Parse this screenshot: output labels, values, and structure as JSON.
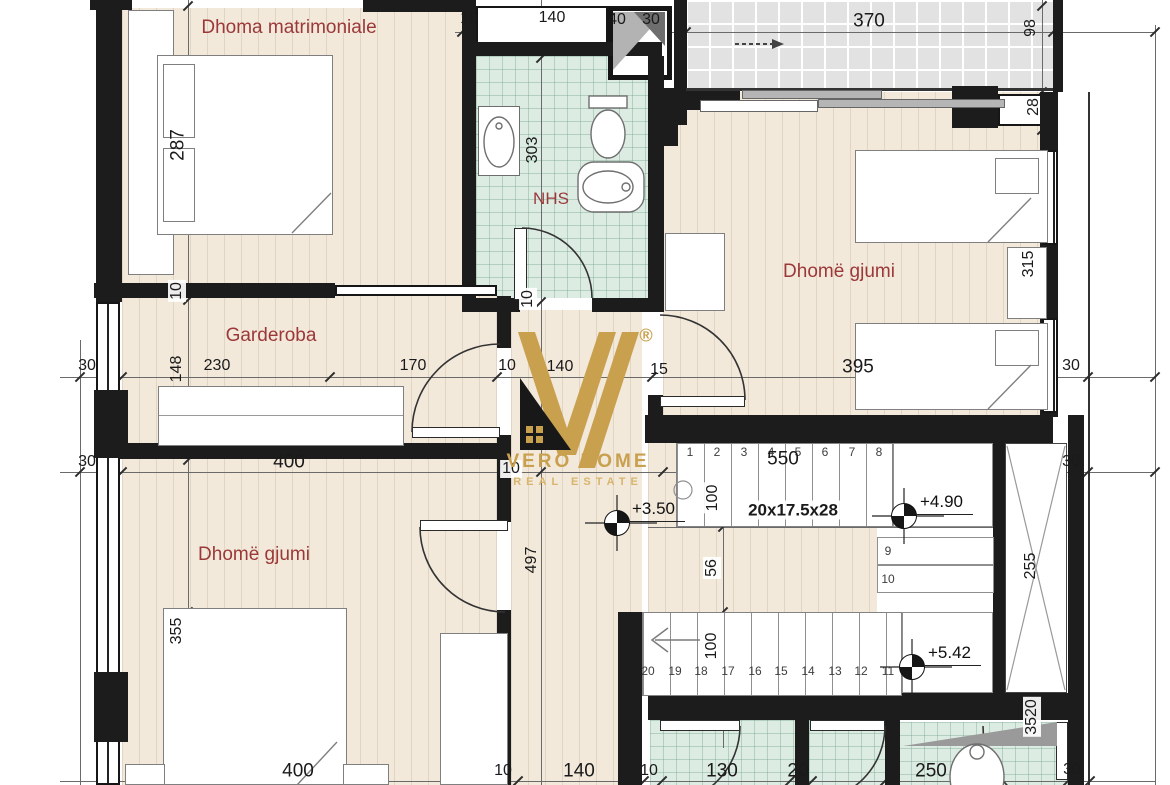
{
  "page": {
    "type": "architectural floor plan"
  },
  "rooms": {
    "master": "Dhoma matrimoniale",
    "bath": "NHS",
    "wardrobe": "Garderoba",
    "bedroom_right": "Dhomë gjumi",
    "bedroom_left": "Dhomë gjumi"
  },
  "logo": {
    "brand": "VERO HOME",
    "tagline": "REAL ESTATE",
    "mark": "®"
  },
  "elevations": {
    "hall": "+3.50",
    "landing": "+4.90",
    "top": "+5.42"
  },
  "stairs": {
    "spec": "20x17.5x28",
    "top_steps": [
      "1",
      "2",
      "3",
      "4",
      "5",
      "6",
      "7",
      "8"
    ],
    "side_steps": [
      "9",
      "10"
    ],
    "bottom_steps": [
      "20",
      "19",
      "18",
      "17",
      "16",
      "15",
      "14",
      "13",
      "12",
      "11"
    ]
  },
  "dims": {
    "top_line": [
      "10",
      "140",
      "40",
      "30",
      "370"
    ],
    "right_col": [
      "98",
      "28"
    ],
    "master_depth": "287",
    "wall_a": "10",
    "mid_line": [
      "30",
      "148",
      "230",
      "170",
      "10",
      "140",
      "15",
      "395",
      "30"
    ],
    "second_line": [
      "30",
      "400",
      "10",
      "550",
      "30"
    ],
    "bath_depth": "303",
    "wall_b": "10",
    "bedroom_right_depth": "315",
    "hall_depth": "497",
    "bedroom_left_depth": "355",
    "stair_segments": [
      "100",
      "56",
      "100"
    ],
    "elevator_depth": "255",
    "shaft": "3520",
    "bottom_line": [
      "400",
      "10",
      "140",
      "10",
      "130",
      "20",
      "250",
      "30"
    ]
  },
  "colors": {
    "wall": "#1c1c1c",
    "room_label": "#9c3838",
    "logo_gold": "#c9a04e",
    "wood_floor": "#f2e9db",
    "bath_tile": "#ddece3",
    "terrace_tile": "#e2e2e2"
  }
}
